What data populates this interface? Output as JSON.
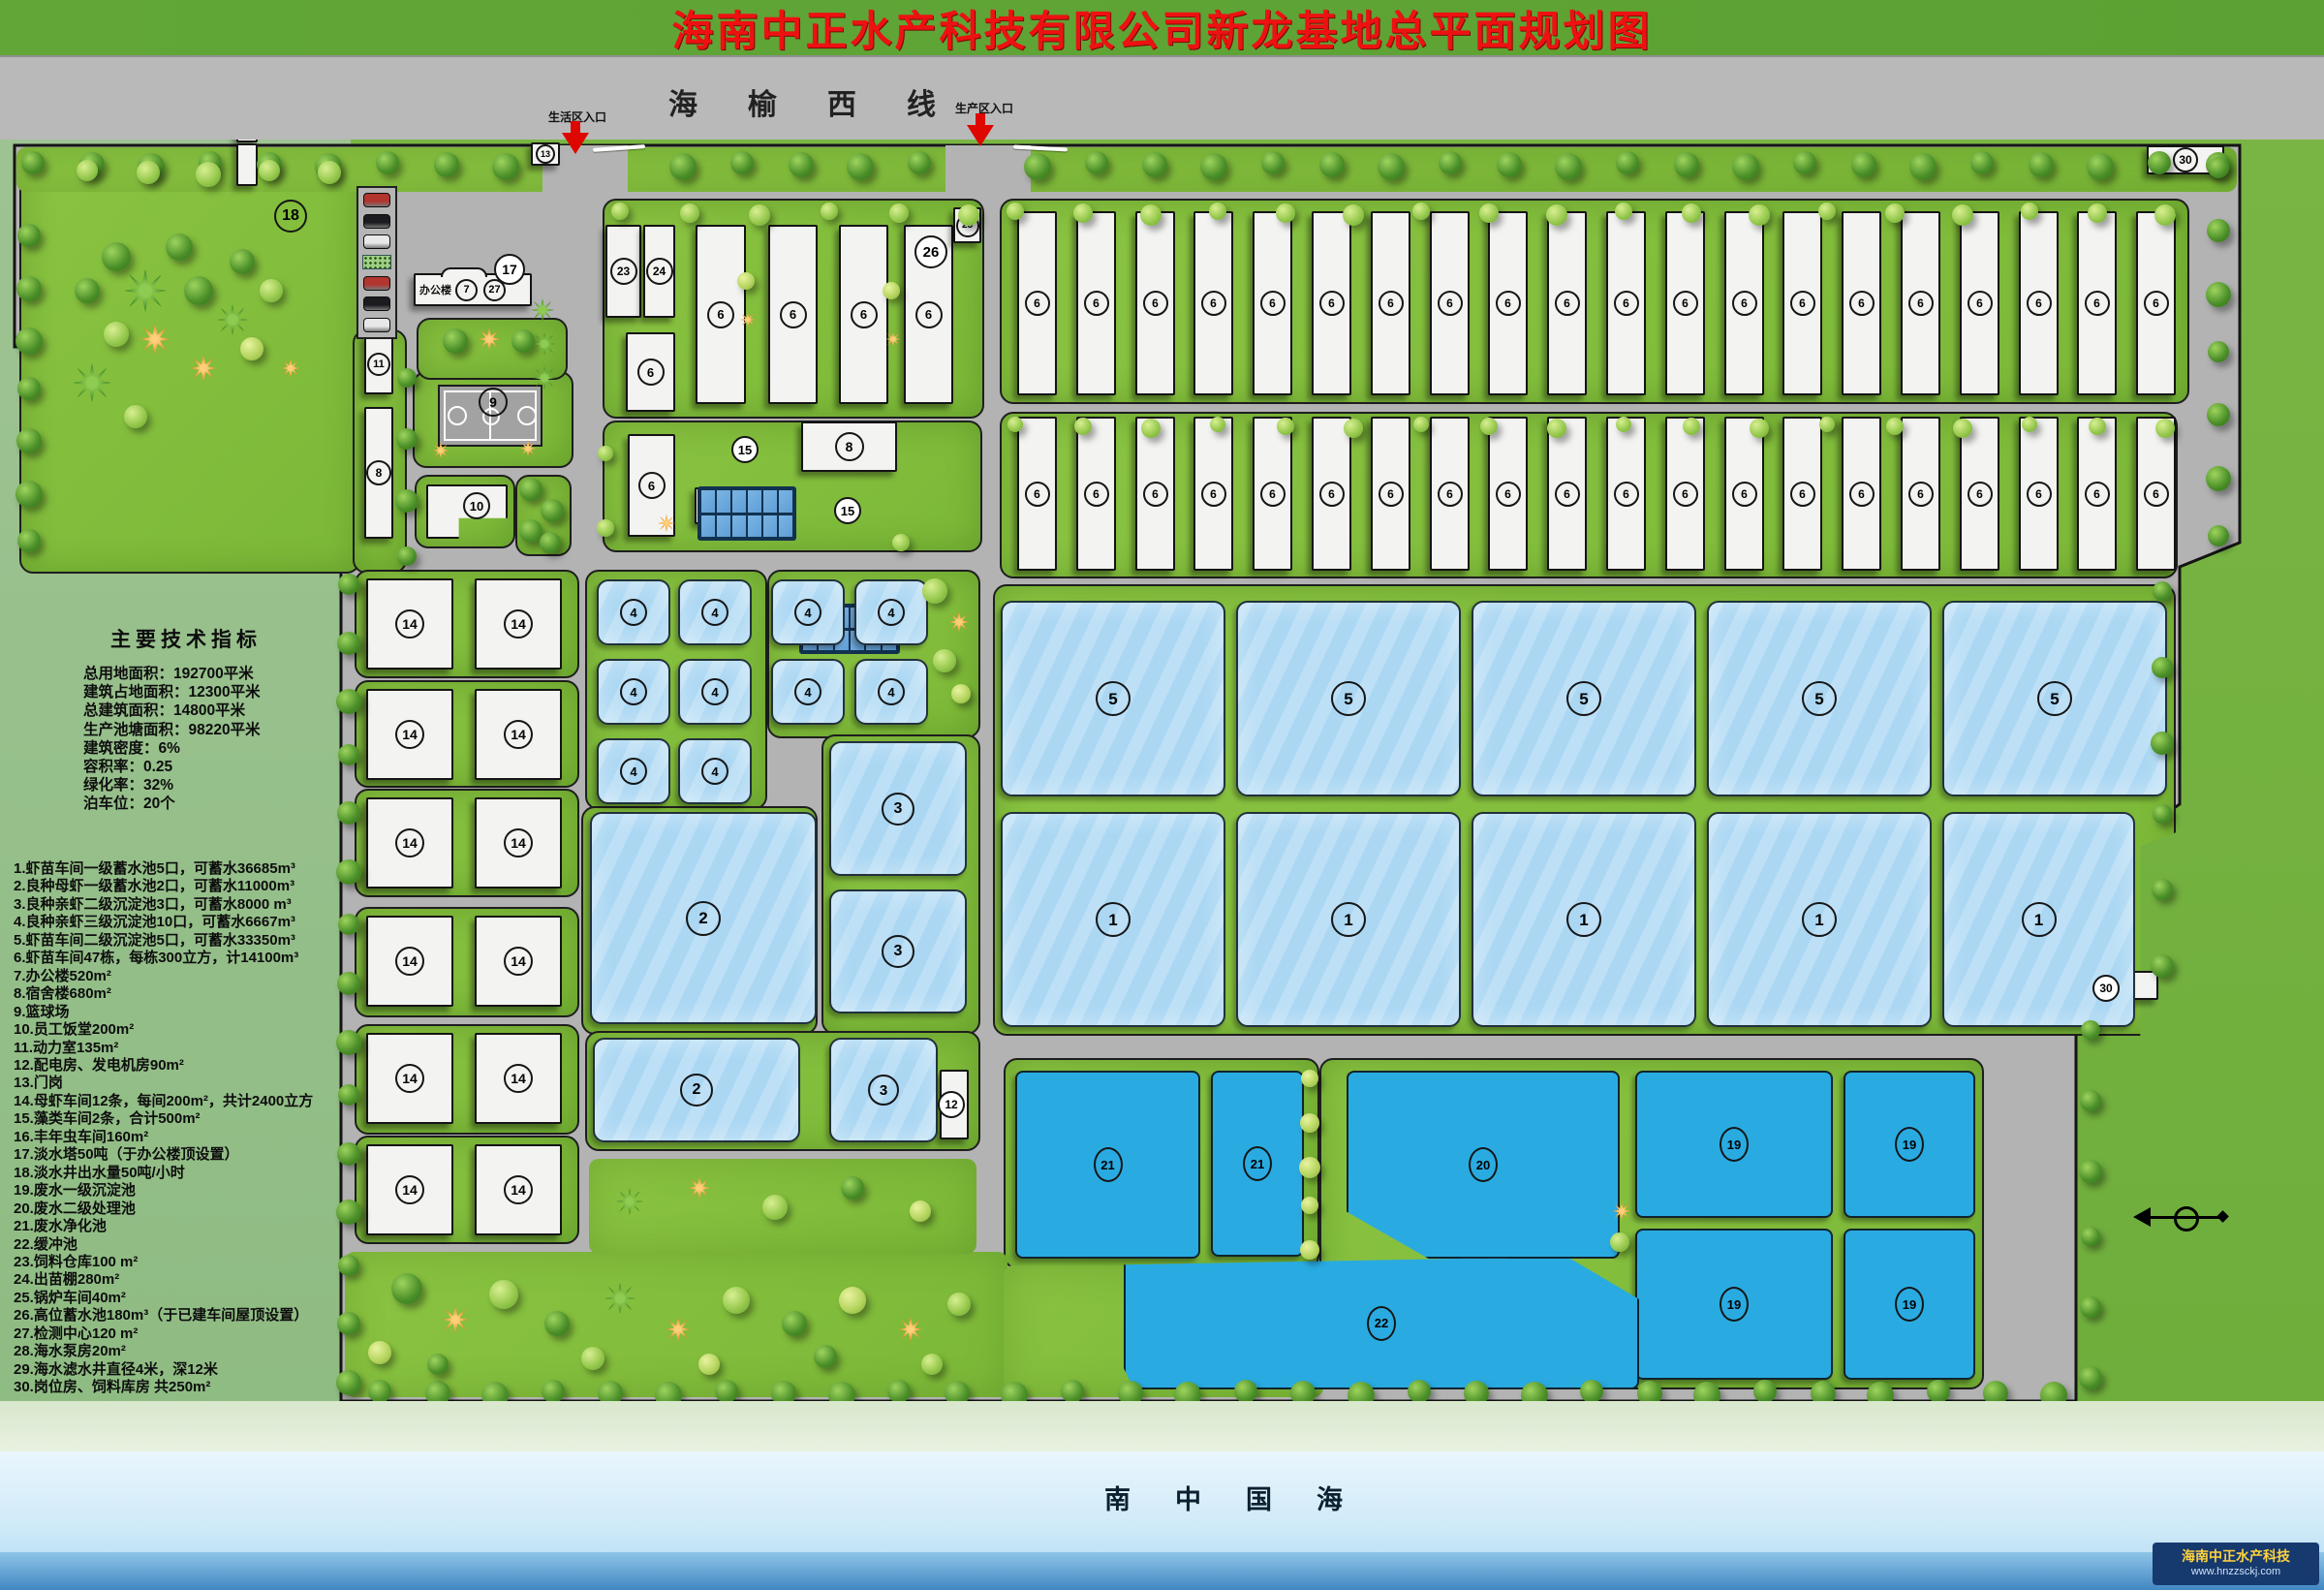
{
  "title": "海南中正水产科技有限公司新龙基地总平面规划图",
  "road": {
    "name": "海榆西线",
    "life_entrance": "生活区入口",
    "production_entrance": "生产区入口"
  },
  "tech": {
    "title": "主要技术指标",
    "lines": [
      "总用地面积：192700平米",
      "建筑占地面积：12300平米",
      "总建筑面积：14800平米",
      "生产池塘面积：98220平米",
      "建筑密度：6%",
      "容积率：0.25",
      "绿化率：32%",
      "泊车位：20个"
    ]
  },
  "legend": {
    "items": [
      "1.虾苗车间一级蓄水池5口，可蓄水36685m³",
      "2.良种母虾一级蓄水池2口，可蓄水11000m³",
      "3.良种亲虾二级沉淀池3口，可蓄水8000 m³",
      "4.良种亲虾三级沉淀池10口，可蓄水6667m³",
      "5.虾苗车间二级沉淀池5口，可蓄水33350m³",
      "6.虾苗车间47栋，每栋300立方，计14100m³",
      "7.办公楼520m²",
      "8.宿舍楼680m²",
      "9.篮球场",
      "10.员工饭堂200m²",
      "11.动力室135m²",
      "12.配电房、发电机房90m²",
      "13.门岗",
      "14.母虾车间12条，每间200m²，共计2400立方",
      "15.藻类车间2条，合计500m²",
      "16.丰年虫车间160m²",
      "17.淡水塔50吨（于办公楼顶设置）",
      "18.淡水井出水量50吨/小时",
      "19.废水一级沉淀池",
      "20.废水二级处理池",
      "21.废水净化池",
      "22.缓冲池",
      "23.饲料仓库100 m²",
      "24.出苗棚280m²",
      "25.锅炉车间40m²",
      "26.高位蓄水池180m³（于已建车间屋顶设置）",
      "27.检测中心120 m²",
      "28.海水泵房20m²",
      "29.海水滤水井直径4米，深12米",
      "30.岗位房、饲料库房 共250m²"
    ]
  },
  "labels": {
    "pond1": "1",
    "pond2": "2",
    "pond3": "3",
    "pond4": "4",
    "pond5": "5",
    "workshop": "6",
    "office_a": "7",
    "dorm": "8",
    "court": "9",
    "canteen": "10",
    "power": "11",
    "genroom": "12",
    "gate": "13",
    "mother": "14",
    "algae": "15",
    "worm": "16",
    "tower": "17",
    "well": "18",
    "sed1": "19",
    "treat2": "20",
    "purify": "21",
    "buffer": "22",
    "feed": "23",
    "nursery": "24",
    "boiler": "25",
    "hitank": "26",
    "test": "27",
    "pump": "28",
    "filter": "29",
    "post": "30"
  },
  "office_label": "办公楼",
  "sea_name": "南中国海",
  "logo": {
    "company": "海南中正水产科技",
    "site": "www.hnzzsckj.com"
  },
  "colors": {
    "band_green": "#61a637",
    "title_red": "#ee1111",
    "road_gray": "#b9b9b9",
    "site_gray": "#b3b3b3",
    "lawn_green": "#84bf3e",
    "pond_light": "#abd7f3",
    "pond_deep": "#29abe2",
    "outside_left": "#97bf8c",
    "outside_right": "#74b23f",
    "sea_blue": "#cfeaf8",
    "logo_navy": "#16396e"
  }
}
